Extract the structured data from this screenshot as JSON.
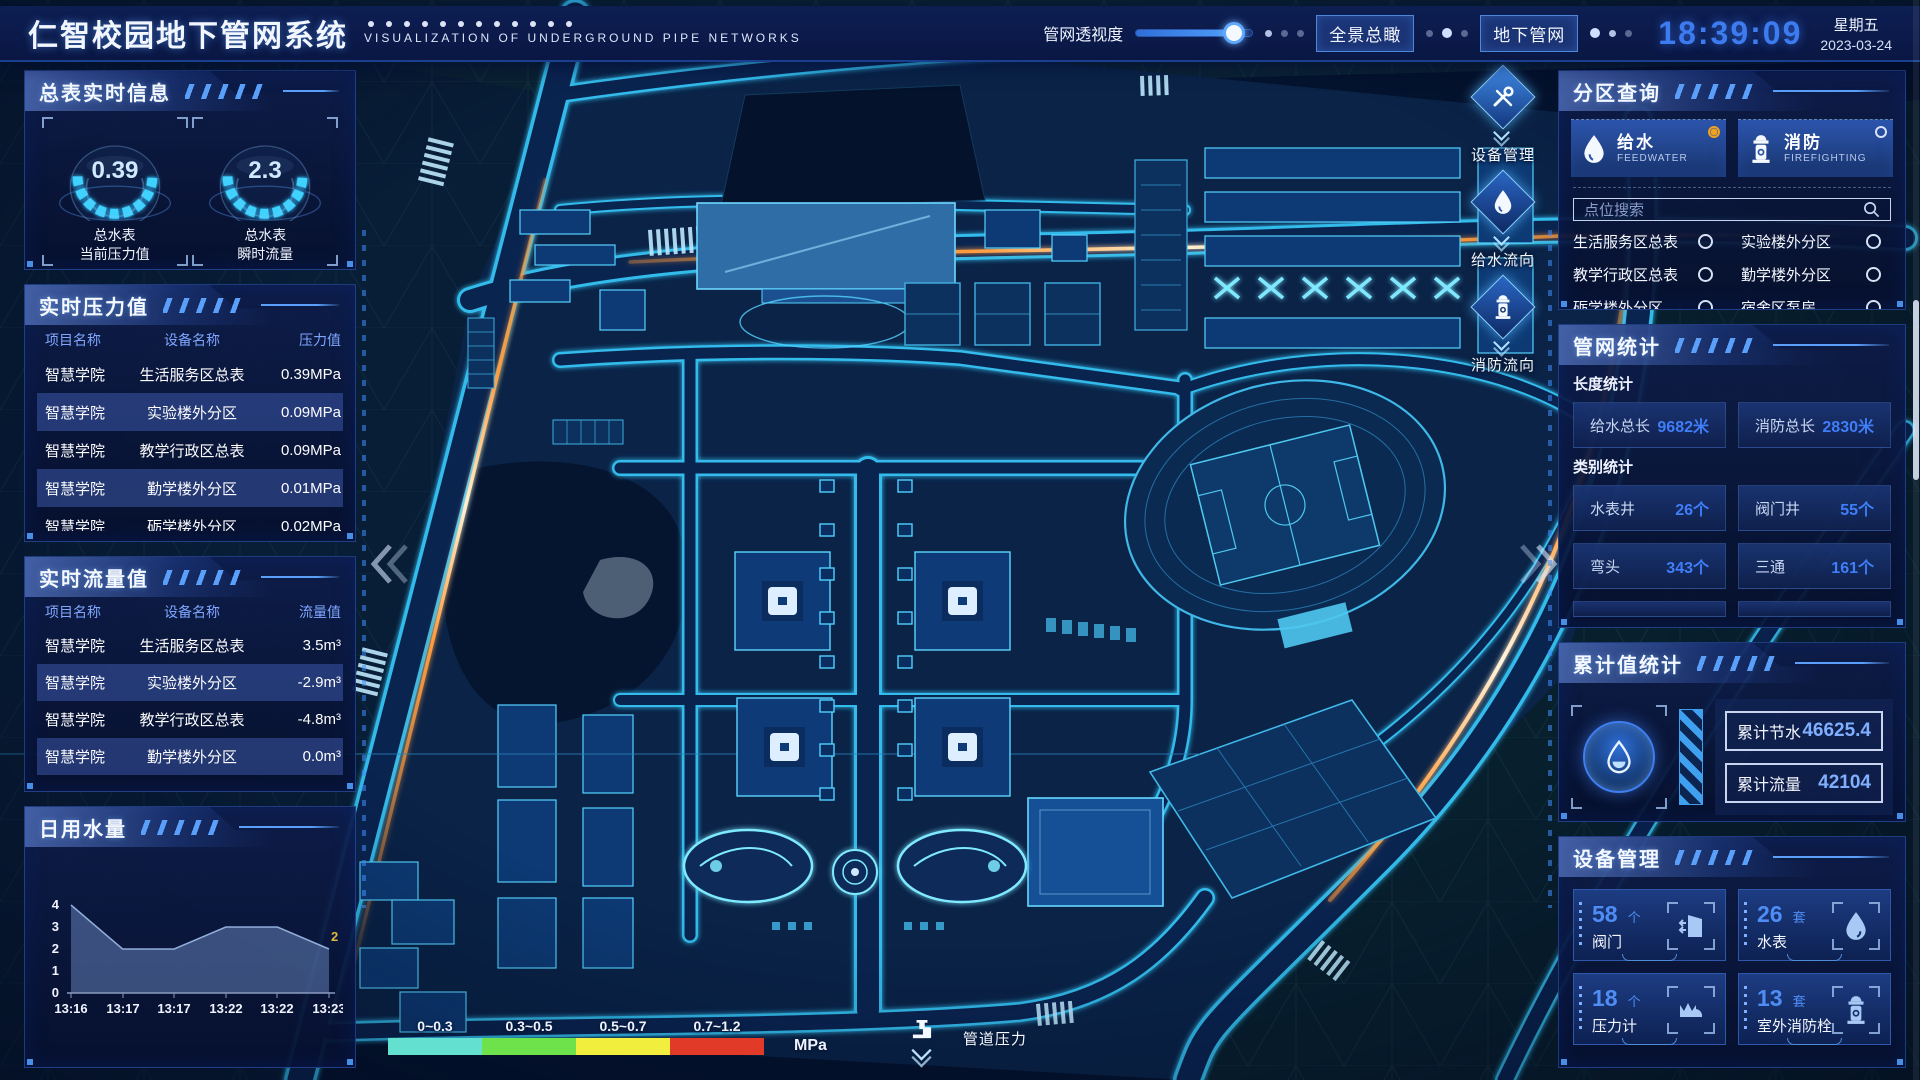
{
  "header": {
    "title": "仁智校园地下管网系统",
    "subtitle": "VISUALIZATION OF UNDERGROUND PIPE NETWORKS",
    "slider_label": "管网透视度",
    "btn_overview": "全景总瞰",
    "btn_underground": "地下管网",
    "time": "18:39:09",
    "weekday": "星期五",
    "date": "2023-03-24"
  },
  "left": {
    "meter_info": {
      "title": "总表实时信息",
      "gauges": [
        {
          "value": "0.39",
          "label1": "总水表",
          "label2": "当前压力值"
        },
        {
          "value": "2.3",
          "label1": "总水表",
          "label2": "瞬时流量"
        }
      ]
    },
    "pressure": {
      "title": "实时压力值",
      "headers": [
        "项目名称",
        "设备名称",
        "压力值"
      ],
      "rows": [
        [
          "智慧学院",
          "生活服务区总表",
          "0.39MPa"
        ],
        [
          "智慧学院",
          "实验楼外分区",
          "0.09MPa"
        ],
        [
          "智慧学院",
          "教学行政区总表",
          "0.09MPa"
        ],
        [
          "智慧学院",
          "勤学楼外分区",
          "0.01MPa"
        ],
        [
          "智慧学院",
          "砺学楼外分区",
          "0.02MPa"
        ]
      ]
    },
    "flow": {
      "title": "实时流量值",
      "headers": [
        "项目名称",
        "设备名称",
        "流量值"
      ],
      "rows": [
        [
          "智慧学院",
          "生活服务区总表",
          "3.5m³"
        ],
        [
          "智慧学院",
          "实验楼外分区",
          "-2.9m³"
        ],
        [
          "智慧学院",
          "教学行政区总表",
          "-4.8m³"
        ],
        [
          "智慧学院",
          "勤学楼外分区",
          "0.0m³"
        ],
        [
          "智慧学院",
          "砺学楼外分区",
          "2.2m³"
        ]
      ]
    },
    "daily": {
      "title": "日用水量"
    }
  },
  "chart_data": {
    "type": "area",
    "title": "日用水量",
    "x": [
      "13:16",
      "13:17",
      "13:17",
      "13:22",
      "13:22",
      "13:23"
    ],
    "values": [
      4,
      2,
      2,
      3,
      3,
      2
    ],
    "ylim": [
      0,
      4
    ],
    "yticks": [
      0,
      1,
      2,
      3,
      4
    ],
    "end_label": "2",
    "grid": false,
    "legend": "none"
  },
  "right": {
    "zone": {
      "title": "分区查询",
      "feedwater": {
        "zh": "给水",
        "en": "FEEDWATER"
      },
      "fire": {
        "zh": "消防",
        "en": "FIREFIGHTING"
      },
      "search_placeholder": "点位搜索",
      "items": [
        "生活服务区总表",
        "实验楼外分区",
        "教学行政区总表",
        "勤学楼外分区",
        "砺学楼外分区",
        "宿舍区泵房"
      ]
    },
    "stats": {
      "title": "管网统计",
      "len_label": "长度统计",
      "cat_label": "类别统计",
      "length": [
        {
          "label": "给水总长",
          "value": "9682米"
        },
        {
          "label": "消防总长",
          "value": "2830米"
        }
      ],
      "categories": [
        {
          "label": "水表井",
          "value": "26个"
        },
        {
          "label": "阀门井",
          "value": "55个"
        },
        {
          "label": "弯头",
          "value": "343个"
        },
        {
          "label": "三通",
          "value": "161个"
        }
      ]
    },
    "cumulative": {
      "title": "累计值统计",
      "rows": [
        {
          "label": "累计节水",
          "value": "46625.4"
        },
        {
          "label": "累计流量",
          "value": "42104"
        }
      ]
    },
    "devices": {
      "title": "设备管理",
      "cards": [
        {
          "count": "58",
          "unit": "个",
          "name": "阀门"
        },
        {
          "count": "26",
          "unit": "套",
          "name": "水表"
        },
        {
          "count": "18",
          "unit": "个",
          "name": "压力计"
        },
        {
          "count": "13",
          "unit": "套",
          "name": "室外消防栓"
        }
      ]
    }
  },
  "map": {
    "toolbar": [
      {
        "label": "设备管理"
      },
      {
        "label": "给水流向"
      },
      {
        "label": "消防流向"
      }
    ],
    "legend": {
      "ranges": [
        "0~0.3",
        "0.3~0.5",
        "0.5~0.7",
        "0.7~1.2"
      ],
      "colors": [
        "#63e0cf",
        "#6ee24a",
        "#f2ee3e",
        "#e23a28"
      ],
      "unit": "MPa",
      "label": "管道压力"
    }
  },
  "colors": {
    "accent": "#3f7ef8",
    "road_glow": "#36c4f4",
    "trail_orange": "#ff9b3d",
    "active_radio": "#f0a21f"
  }
}
